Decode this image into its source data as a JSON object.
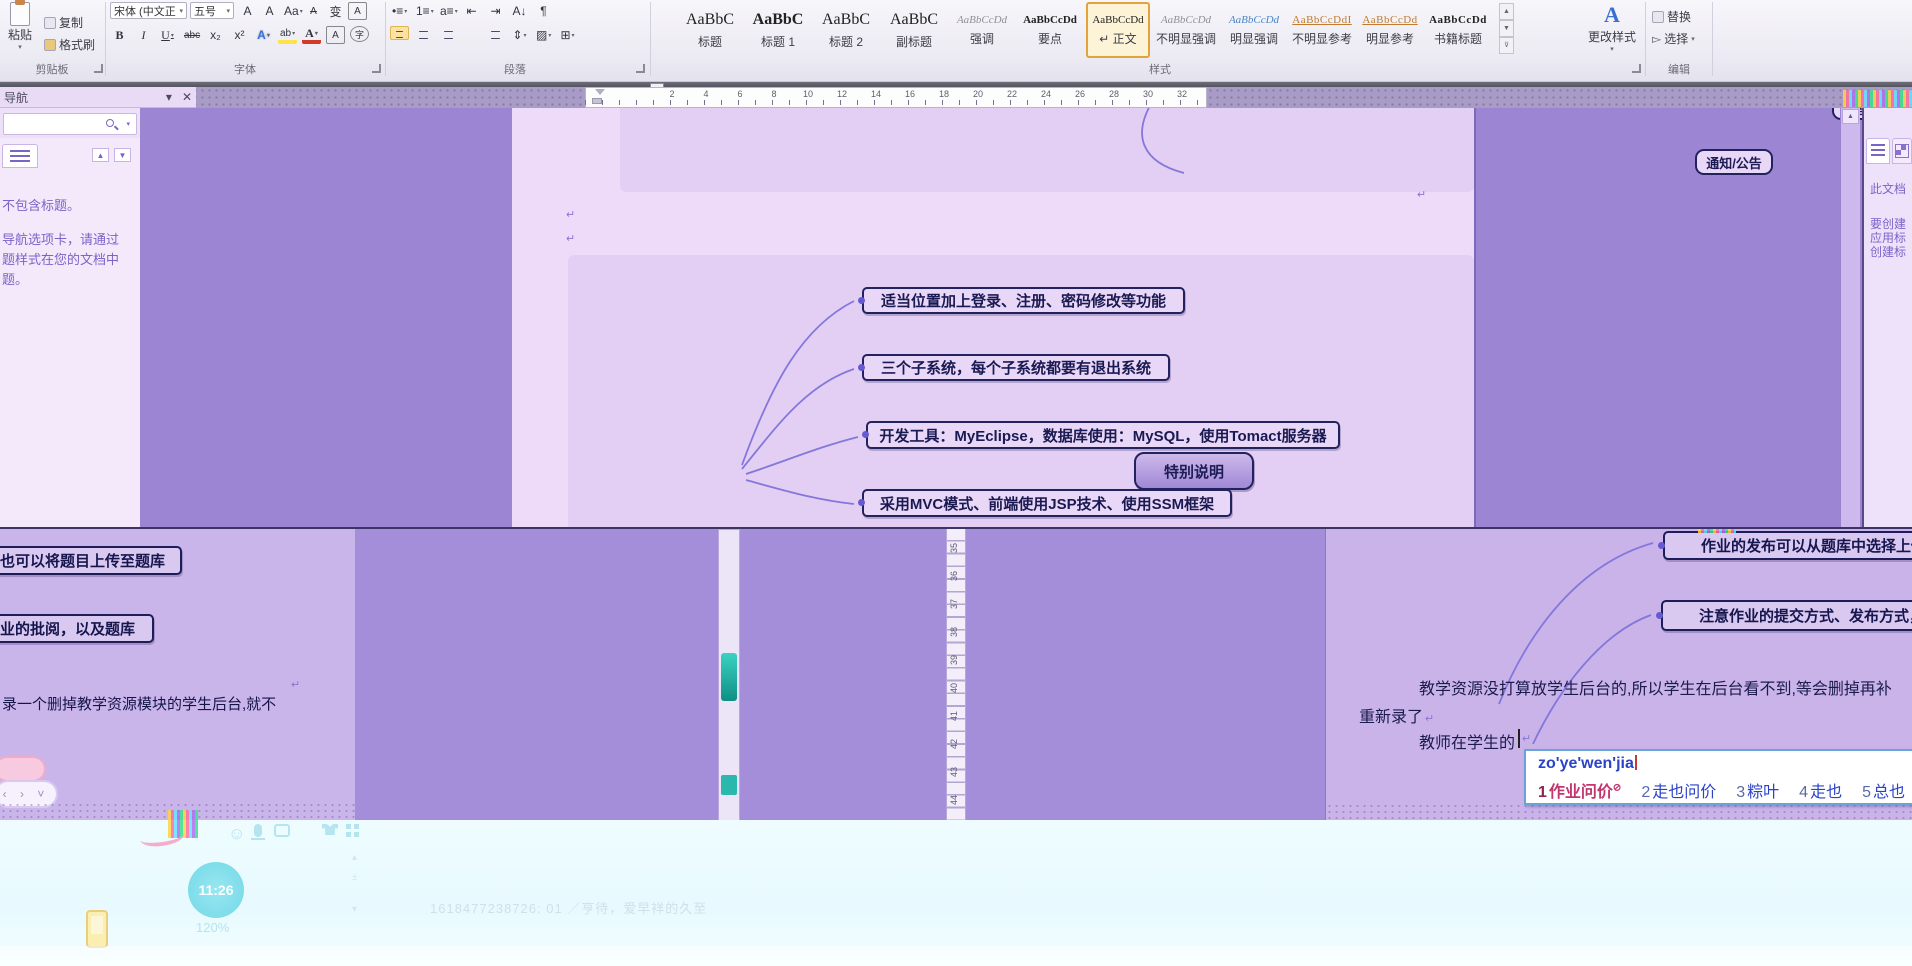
{
  "symbols": {
    "pilcrow": "↵",
    "dropdown": "▾",
    "up": "▲",
    "down": "▼",
    "close": "✕",
    "scroll_up": "▲",
    "chevrons": "‹ › ˅"
  },
  "ribbon": {
    "clipboard": {
      "paste": "粘贴",
      "copy": "复制",
      "format_painter": "格式刷",
      "group": "剪贴板"
    },
    "font": {
      "group": "字体",
      "font_name": "宋体 (中文正",
      "font_size": "五号",
      "row1": [
        {
          "name": "grow-font-icon",
          "glyph": "A",
          "cls": ""
        },
        {
          "name": "shrink-font-icon",
          "glyph": "A",
          "cls": "sm"
        },
        {
          "name": "change-case-icon",
          "glyph": "Aa",
          "cls": "dd"
        },
        {
          "name": "clear-formatting-icon",
          "glyph": "A",
          "cls": "st"
        },
        {
          "name": "phonetic-guide-icon",
          "glyph": "变",
          "cls": ""
        },
        {
          "name": "character-border-icon",
          "glyph": "A",
          "cls": "boxed"
        }
      ],
      "row2": [
        {
          "name": "bold-button",
          "glyph": "B",
          "cls": "b"
        },
        {
          "name": "italic-button",
          "glyph": "I",
          "cls": "i"
        },
        {
          "name": "underline-button",
          "glyph": "U",
          "cls": "u dd"
        },
        {
          "name": "strikethrough-button",
          "glyph": "abc",
          "cls": "st"
        },
        {
          "name": "subscript-button",
          "glyph": "x₂",
          "cls": ""
        },
        {
          "name": "superscript-button",
          "glyph": "x²",
          "cls": ""
        },
        {
          "name": "text-effects-button",
          "glyph": "A",
          "cls": "fx dd"
        },
        {
          "name": "highlight-button",
          "glyph": "ab",
          "cls": "hl dd"
        },
        {
          "name": "font-color-button",
          "glyph": "A",
          "cls": "fc dd"
        },
        {
          "name": "char-shading-button",
          "glyph": "A",
          "cls": "boxed"
        },
        {
          "name": "enclose-character-button",
          "glyph": "字",
          "cls": "circ"
        }
      ]
    },
    "paragraph": {
      "group": "段落",
      "row1": [
        {
          "name": "bullets-icon",
          "glyph": "•≡",
          "cls": "dd"
        },
        {
          "name": "numbering-icon",
          "glyph": "1≡",
          "cls": "dd"
        },
        {
          "name": "multilevel-list-icon",
          "glyph": "a≡",
          "cls": "dd"
        },
        {
          "name": "decrease-indent-icon",
          "glyph": "⇤",
          "cls": ""
        },
        {
          "name": "increase-indent-icon",
          "glyph": "⇥",
          "cls": ""
        },
        {
          "name": "sort-icon",
          "glyph": "A↓",
          "cls": ""
        },
        {
          "name": "show-marks-icon",
          "glyph": "¶",
          "cls": ""
        }
      ],
      "row2": [
        {
          "name": "align-left-button",
          "type": "al al-l",
          "active": true
        },
        {
          "name": "align-center-button",
          "type": "al al-c"
        },
        {
          "name": "align-right-button",
          "type": "al al-r"
        },
        {
          "name": "justify-button",
          "type": "al al-j"
        },
        {
          "name": "distribute-button",
          "type": "al al-c"
        },
        {
          "name": "line-spacing-button",
          "glyph": "⇕",
          "cls": "dd"
        },
        {
          "name": "shading-button",
          "glyph": "▨",
          "cls": "dd"
        },
        {
          "name": "borders-button",
          "glyph": "⊞",
          "cls": "dd"
        }
      ]
    },
    "styles": {
      "group": "样式",
      "change_styles": "更改样式",
      "items": [
        {
          "preview": "AaBbC",
          "label": "标题",
          "pcls": ""
        },
        {
          "preview": "AaBbC",
          "label": "标题 1",
          "pcls": "bold"
        },
        {
          "preview": "AaBbC",
          "label": "标题 2",
          "pcls": ""
        },
        {
          "preview": "AaBbC",
          "label": "副标题",
          "pcls": ""
        },
        {
          "preview": "AaBbCcDd",
          "label": "强调",
          "pcls": "sm it gray"
        },
        {
          "preview": "AaBbCcDd",
          "label": "要点",
          "pcls": "sm bold"
        },
        {
          "preview": "AaBbCcDd",
          "label": "↵ 正文",
          "pcls": "sm",
          "selected": true
        },
        {
          "preview": "AaBbCcDd",
          "label": "不明显强调",
          "pcls": "sm it gray"
        },
        {
          "preview": "AaBbCcDd",
          "label": "明显强调",
          "pcls": "sm it blue"
        },
        {
          "preview": "AaBbCcDdI",
          "label": "不明显参考",
          "pcls": "sm caps orange"
        },
        {
          "preview": "AaBbCcDd",
          "label": "明显参考",
          "pcls": "sm caps orange"
        },
        {
          "preview": "AaBbCcDd",
          "label": "书籍标题",
          "pcls": "sm caps bold"
        }
      ]
    },
    "editing": {
      "group": "编辑",
      "replace": "替换",
      "select": "选择"
    }
  },
  "nav_pane": {
    "title": "导航",
    "lines": [
      "不包含标题。",
      "导航选项卡，请通过",
      "题样式在您的文档中",
      "题。"
    ]
  },
  "right_nav_pane": {
    "lines": [
      "此文档",
      "要创建",
      "应用标",
      "创建标"
    ]
  },
  "rulers": {
    "h_numbers": [
      2,
      4,
      6,
      8,
      10,
      12,
      14,
      16,
      18,
      20,
      22,
      24,
      26,
      28,
      30,
      32
    ],
    "v_left": [
      17,
      18,
      19,
      20,
      21,
      22,
      23,
      24,
      25,
      26,
      27,
      28,
      29,
      30,
      31,
      32
    ],
    "v_mid": [
      35,
      36,
      37,
      38,
      39,
      40,
      41,
      42,
      43,
      44
    ]
  },
  "mindmap": {
    "root": "特别说明",
    "top_boxes": [
      "管理员",
      "通知/公告"
    ],
    "branches": [
      "适当位置加上登录、注册、密码修改等功能",
      "三个子系统，每个子系统都要有退出系统",
      "开发工具：MyEclipse，数据库使用：MySQL，使用Tomact服务器",
      "采用MVC模式、前端使用JSP技术、使用SSM框架"
    ]
  },
  "doc_bottom_left": {
    "boxes": [
      "也可以将题目上传至题库",
      "业的批阅，以及题库"
    ],
    "text": "录一个删掉教学资源模块的学生后台,就不"
  },
  "doc_bottom_right": {
    "boxes": [
      "作业的发布可以从题库中选择上传，",
      "注意作业的提交方式、发布方式，作"
    ],
    "lines": [
      "教学资源没打算放学生后台的,所以学生在后台看不到,等会删掉再补",
      "重新录了",
      "教师在学生的"
    ],
    "ime": {
      "pinyin": "zo'ye'wen'jia",
      "candidates": [
        {
          "n": "1",
          "t": "作业问价",
          "red": true,
          "sup": "⊘"
        },
        {
          "n": "2",
          "t": "走也问价"
        },
        {
          "n": "3",
          "t": "粽叶"
        },
        {
          "n": "4",
          "t": "走也"
        },
        {
          "n": "5",
          "t": "总也"
        }
      ]
    }
  },
  "taskbar": {
    "clock": "11:26",
    "zoom_level": "120%",
    "watermark": "1618477238726: 01 ／亨待，爱早祥的久至",
    "icons": [
      {
        "name": "smiley-icon",
        "x": 228
      },
      {
        "name": "mic-icon",
        "x": 254
      },
      {
        "name": "window-icon",
        "x": 274
      },
      {
        "name": "shirt-icon",
        "x": 322
      },
      {
        "name": "grid-icon",
        "x": 346
      }
    ]
  },
  "colors": {
    "accent_selection": "#e2a33c",
    "box_border": "#1d1d5a",
    "canvas_purple": "#a189d6",
    "page_lavender": "#eddbf9",
    "ime_blue": "#2a43c8",
    "ime_red": "#c2356e",
    "teal_scroll": "#2ab8ac"
  }
}
